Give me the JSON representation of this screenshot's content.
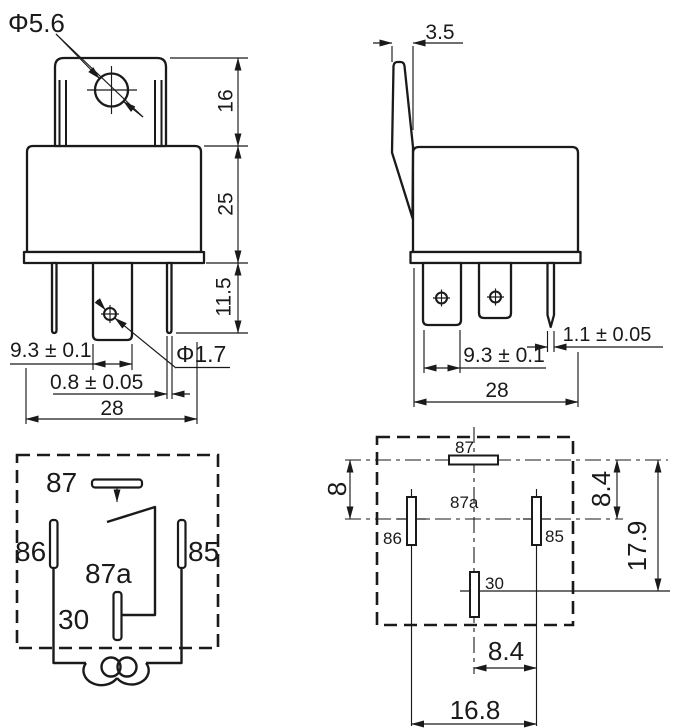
{
  "front_view": {
    "hole_diameter": "Φ5.6",
    "tab_height": "16",
    "body_height": "25",
    "pin_length": "11.5",
    "pin_spacing": "9.3 ± 0.1",
    "pin_hole_diameter": "Φ1.7",
    "pin_thickness": "0.8 ± 0.05",
    "overall_width": "28"
  },
  "side_view": {
    "tab_thickness": "3.5",
    "pin_spacing": "9.3 ± 0.1",
    "pin_thickness": "1.1 ± 0.05",
    "overall_width": "28"
  },
  "schematic": {
    "pin_87": "87",
    "pin_86": "86",
    "pin_85": "85",
    "pin_87a": "87a",
    "pin_30": "30"
  },
  "bottom_view": {
    "pin_87": "87",
    "pin_87a": "87a",
    "pin_86": "86",
    "pin_85": "85",
    "pin_30": "30",
    "offset_top": "8",
    "offset_upper": "8.4",
    "offset_total": "17.9",
    "half_span": "8.4",
    "full_span": "16.8"
  }
}
